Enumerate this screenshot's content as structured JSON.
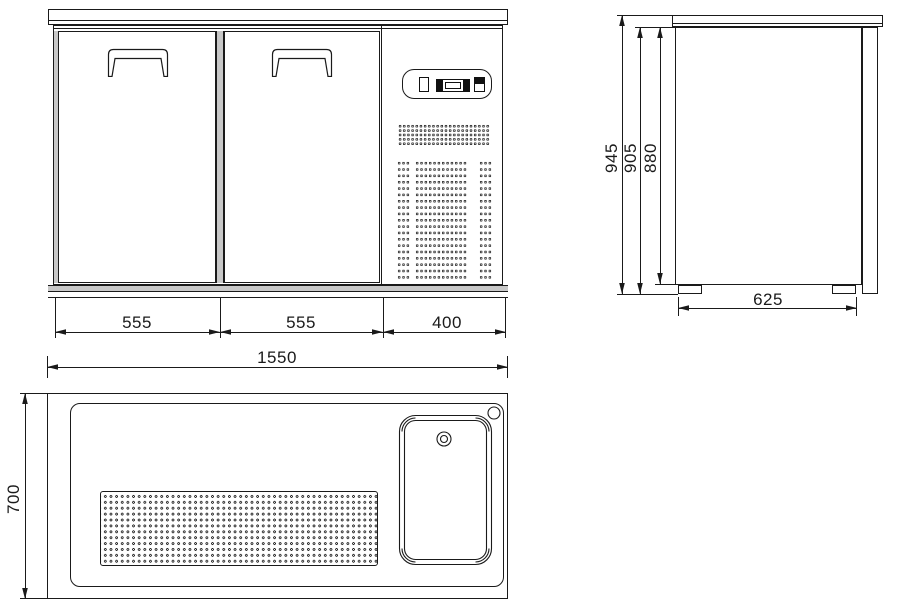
{
  "drawing": {
    "front_view": {
      "dim_door_left": "555",
      "dim_door_right": "555",
      "dim_compartment": "400"
    },
    "side_view": {
      "dim_height_total": "945",
      "dim_height_under_top": "905",
      "dim_height_body": "880",
      "dim_depth_feet": "625"
    },
    "top_view": {
      "dim_width_total": "1550",
      "dim_depth_total": "700"
    },
    "colors": {
      "line": "#1a1a1a",
      "frame_fill": "#c8c8c8",
      "background": "#ffffff"
    }
  }
}
